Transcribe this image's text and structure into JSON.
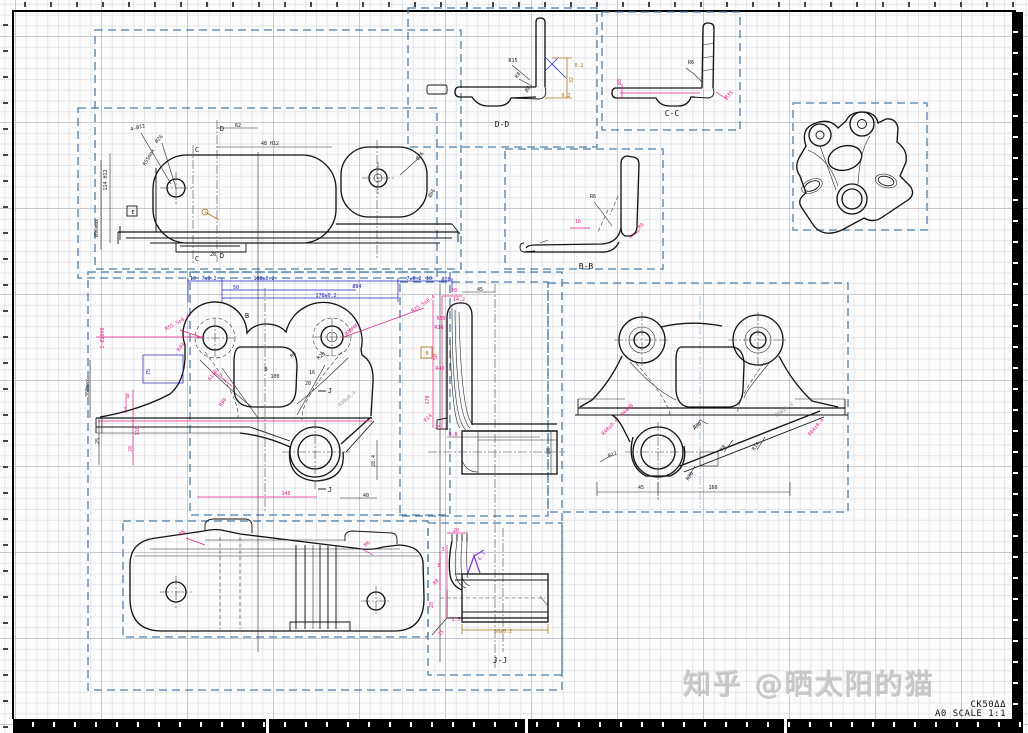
{
  "canvas": {
    "width": 1028,
    "height": 733
  },
  "title_block": {
    "model": "CK50ΔΔ",
    "sheet": "A0 SCALE 1:1"
  },
  "watermark": {
    "text": "知乎 @晒太阳的猫"
  },
  "colors": {
    "k": "#1a1a1a",
    "dim": "#e0218a",
    "blue": "#2222bb",
    "olive": "#a87714",
    "gray": "#9a9a9a",
    "purple": "#8040d0",
    "frame": "#4d7ea8"
  },
  "labels": [
    {
      "t": "D-D",
      "x": 502,
      "y": 127,
      "s": 8,
      "n": "section-label-dd"
    },
    {
      "t": "C-C",
      "x": 672,
      "y": 116,
      "s": 8,
      "n": "section-label-cc"
    },
    {
      "t": "B-B",
      "x": 586,
      "y": 269,
      "s": 8,
      "n": "section-label-bb"
    },
    {
      "t": "J-J",
      "x": 500,
      "y": 663,
      "s": 8,
      "n": "section-label-jj"
    },
    {
      "t": "D",
      "x": 222,
      "y": 131,
      "s": 7,
      "n": "cut-marker-d"
    },
    {
      "t": "D",
      "x": 222,
      "y": 258,
      "s": 7,
      "n": "cut-marker-d"
    },
    {
      "t": "C",
      "x": 197,
      "y": 152,
      "s": 7,
      "n": "cut-marker-c"
    },
    {
      "t": "C",
      "x": 197,
      "y": 261,
      "s": 7,
      "n": "cut-marker-c"
    },
    {
      "t": "J",
      "x": 330,
      "y": 393,
      "s": 7,
      "n": "cut-marker-j"
    },
    {
      "t": "J",
      "x": 330,
      "y": 492,
      "s": 7,
      "n": "cut-marker-j"
    },
    {
      "t": "B",
      "x": 247,
      "y": 318,
      "s": 7,
      "n": "cut-marker-b"
    },
    {
      "t": "B",
      "x": 427,
      "y": 355,
      "s": 5,
      "c": "olive",
      "n": "datum-b"
    },
    {
      "t": "E",
      "x": 133,
      "y": 214,
      "s": 5,
      "n": "datum-e"
    },
    {
      "t": "4-Ø12",
      "x": 138,
      "y": 129,
      "r": -15
    },
    {
      "t": "Ø26",
      "x": 160,
      "y": 140,
      "r": -45
    },
    {
      "t": "R55max",
      "x": 150,
      "y": 158,
      "r": -60
    },
    {
      "t": "48 H12",
      "x": 270,
      "y": 145
    },
    {
      "t": "62",
      "x": 238,
      "y": 127
    },
    {
      "t": "Ø26",
      "x": 421,
      "y": 157,
      "r": -50
    },
    {
      "t": "Ø66",
      "x": 433,
      "y": 194,
      "r": -60
    },
    {
      "t": "114 H12",
      "x": 107,
      "y": 180,
      "r": -90
    },
    {
      "t": "Ø96max",
      "x": 98,
      "y": 228,
      "r": -90
    },
    {
      "t": "28",
      "x": 213,
      "y": 256
    },
    {
      "t": "10",
      "x": 193,
      "y": 280,
      "c": "blue"
    },
    {
      "t": "7±0.2",
      "x": 209,
      "y": 280,
      "c": "blue"
    },
    {
      "t": "188±0.2",
      "x": 264,
      "y": 280,
      "c": "blue"
    },
    {
      "t": "7±0.2",
      "x": 414,
      "y": 280,
      "c": "blue"
    },
    {
      "t": "10",
      "x": 429,
      "y": 280,
      "c": "blue"
    },
    {
      "t": "Ø20",
      "x": 446,
      "y": 281,
      "c": "blue"
    },
    {
      "t": "50",
      "x": 236,
      "y": 289,
      "c": "blue"
    },
    {
      "t": "Ø84",
      "x": 357,
      "y": 288,
      "c": "blue"
    },
    {
      "t": "178±0.2",
      "x": 326,
      "y": 297,
      "c": "blue"
    },
    {
      "t": "75",
      "x": 150,
      "y": 372,
      "r": -90,
      "c": "blue"
    },
    {
      "t": "R55.5±0.4",
      "x": 178,
      "y": 324,
      "r": -30,
      "c": "dim"
    },
    {
      "t": "2-Ø20H8",
      "x": 104,
      "y": 338,
      "r": -90,
      "c": "dim"
    },
    {
      "t": "R25.5±0.4",
      "x": 424,
      "y": 305,
      "r": -35,
      "c": "dim"
    },
    {
      "t": "Ø20H8",
      "x": 352,
      "y": 331,
      "r": -40,
      "c": "dim"
    },
    {
      "t": "R40",
      "x": 182,
      "y": 348,
      "r": -55,
      "c": "dim"
    },
    {
      "t": "R140",
      "x": 214,
      "y": 376,
      "r": -55,
      "c": "dim"
    },
    {
      "t": "R90",
      "x": 224,
      "y": 403,
      "r": -55,
      "c": "dim"
    },
    {
      "t": "9",
      "x": 128,
      "y": 398,
      "c": "dim"
    },
    {
      "t": "3",
      "x": 125,
      "y": 411,
      "c": "dim"
    },
    {
      "t": "110",
      "x": 139,
      "y": 431,
      "r": -90,
      "c": "dim"
    },
    {
      "t": "28",
      "x": 132,
      "y": 449,
      "r": -90,
      "c": "dim"
    },
    {
      "t": "140",
      "x": 286,
      "y": 495,
      "c": "dim"
    },
    {
      "t": "100",
      "x": 275,
      "y": 378
    },
    {
      "t": "16",
      "x": 312,
      "y": 374
    },
    {
      "t": "20",
      "x": 308,
      "y": 385
    },
    {
      "t": "B",
      "x": 266,
      "y": 371
    },
    {
      "t": "R20",
      "x": 322,
      "y": 357,
      "r": -40
    },
    {
      "t": "R8",
      "x": 294,
      "y": 356,
      "r": -40
    },
    {
      "t": "360max",
      "x": 89,
      "y": 388,
      "r": -90
    },
    {
      "t": "25",
      "x": 99,
      "y": 441,
      "r": -90
    },
    {
      "t": "40",
      "x": 366,
      "y": 497
    },
    {
      "t": "28.4",
      "x": 375,
      "y": 461,
      "r": -90
    },
    {
      "t": "R30±0.4",
      "x": 348,
      "y": 400,
      "r": -40,
      "c": "gray"
    },
    {
      "t": "20",
      "x": 454,
      "y": 292,
      "c": "dim"
    },
    {
      "t": "45",
      "x": 480,
      "y": 291
    },
    {
      "t": "14.2",
      "x": 459,
      "y": 301,
      "c": "dim"
    },
    {
      "t": "R50",
      "x": 441,
      "y": 320,
      "c": "dim"
    },
    {
      "t": "R16",
      "x": 439,
      "y": 329,
      "c": "dim"
    },
    {
      "t": "50",
      "x": 437,
      "y": 357,
      "r": -90,
      "c": "dim"
    },
    {
      "t": "R40",
      "x": 440,
      "y": 370,
      "c": "dim"
    },
    {
      "t": "170",
      "x": 429,
      "y": 400,
      "r": -90,
      "c": "dim"
    },
    {
      "t": "R14",
      "x": 429,
      "y": 419,
      "r": -45,
      "c": "dim"
    },
    {
      "t": "25",
      "x": 438,
      "y": 429,
      "c": "dim"
    },
    {
      "t": "9.8",
      "x": 453,
      "y": 436,
      "c": "dim"
    },
    {
      "t": "28",
      "x": 550,
      "y": 451,
      "r": -90
    },
    {
      "t": "R48±0.4",
      "x": 611,
      "y": 428,
      "r": -45,
      "c": "dim"
    },
    {
      "t": "Ø44H8",
      "x": 628,
      "y": 411,
      "r": -45,
      "c": "dim"
    },
    {
      "t": "R64±0.4",
      "x": 817,
      "y": 428,
      "r": -50,
      "c": "dim"
    },
    {
      "t": "208±0.4",
      "x": 785,
      "y": 411,
      "r": -35,
      "c": "gray"
    },
    {
      "t": "R30",
      "x": 698,
      "y": 427,
      "r": -30
    },
    {
      "t": "R8",
      "x": 724,
      "y": 449,
      "r": -55
    },
    {
      "t": "R14",
      "x": 757,
      "y": 447,
      "r": -55
    },
    {
      "t": "R12",
      "x": 613,
      "y": 456,
      "r": -20
    },
    {
      "t": "R30",
      "x": 691,
      "y": 477,
      "r": -55
    },
    {
      "t": "45",
      "x": 641,
      "y": 489
    },
    {
      "t": "160",
      "x": 713,
      "y": 489
    },
    {
      "t": "R6",
      "x": 183,
      "y": 534,
      "r": -45,
      "c": "dim"
    },
    {
      "t": "R6",
      "x": 368,
      "y": 545,
      "r": -45,
      "c": "dim"
    },
    {
      "t": "20",
      "x": 456,
      "y": 532,
      "c": "dim"
    },
    {
      "t": "3",
      "x": 443,
      "y": 551,
      "c": "dim"
    },
    {
      "t": "8",
      "x": 439,
      "y": 567,
      "c": "dim"
    },
    {
      "t": "R8",
      "x": 437,
      "y": 583,
      "r": -45,
      "c": "dim"
    },
    {
      "t": "28",
      "x": 433,
      "y": 605,
      "r": -90,
      "c": "dim"
    },
    {
      "t": "1.5",
      "x": 456,
      "y": 621,
      "c": "dim"
    },
    {
      "t": "15",
      "x": 442,
      "y": 634,
      "r": -45,
      "c": "dim"
    },
    {
      "t": "50±0.2",
      "x": 503,
      "y": 633,
      "c": "olive"
    },
    {
      "t": "6.3",
      "x": 483,
      "y": 557,
      "r": -55,
      "c": "purple"
    },
    {
      "t": "R15",
      "x": 513,
      "y": 62
    },
    {
      "t": "R8",
      "x": 519,
      "y": 76,
      "r": -55
    },
    {
      "t": "Ø8",
      "x": 529,
      "y": 90,
      "r": -55
    },
    {
      "t": "32",
      "x": 573,
      "y": 80,
      "r": -90,
      "c": "olive"
    },
    {
      "t": "9.2",
      "x": 566,
      "y": 97,
      "c": "olive"
    },
    {
      "t": "0.2",
      "x": 579,
      "y": 67,
      "c": "olive"
    },
    {
      "t": "R6",
      "x": 691,
      "y": 64
    },
    {
      "t": "Ø8",
      "x": 621,
      "y": 82,
      "r": -90,
      "c": "dim"
    },
    {
      "t": "R35",
      "x": 730,
      "y": 96,
      "r": -45,
      "c": "dim"
    },
    {
      "t": "R6",
      "x": 593,
      "y": 198
    },
    {
      "t": "16",
      "x": 578,
      "y": 223,
      "c": "dim"
    },
    {
      "t": "R9",
      "x": 642,
      "y": 227,
      "r": -45,
      "c": "dim"
    }
  ]
}
